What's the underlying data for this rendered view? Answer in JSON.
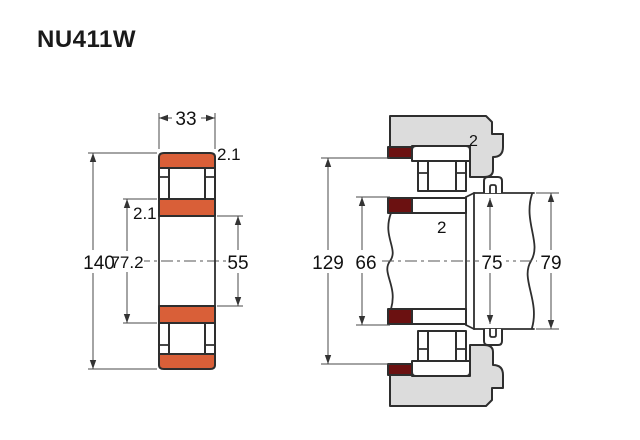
{
  "title": "NU411W",
  "colors": {
    "ring_orange": "#d95f38",
    "abutment_dark_red": "#6b1111",
    "housing_gray": "#dcdcdc",
    "outline": "#2e2e2e",
    "dimension_line": "#4a4a4a",
    "text": "#111111",
    "background": "#ffffff"
  },
  "section_view": {
    "labels": {
      "width": "33",
      "outer_chamfer": "2.1",
      "inner_chamfer": "2.1",
      "outer_diameter": "140",
      "raceway_diameter": "77.2",
      "bore_diameter": "55"
    }
  },
  "mounting_view": {
    "labels": {
      "housing_abutment_diameter": "129",
      "shaft_abutment_diameter": "66",
      "outer_ring_chamfer": "2",
      "inner_ring_chamfer": "2",
      "right_abutment_diameter": "75",
      "shaft_diameter": "79"
    }
  }
}
